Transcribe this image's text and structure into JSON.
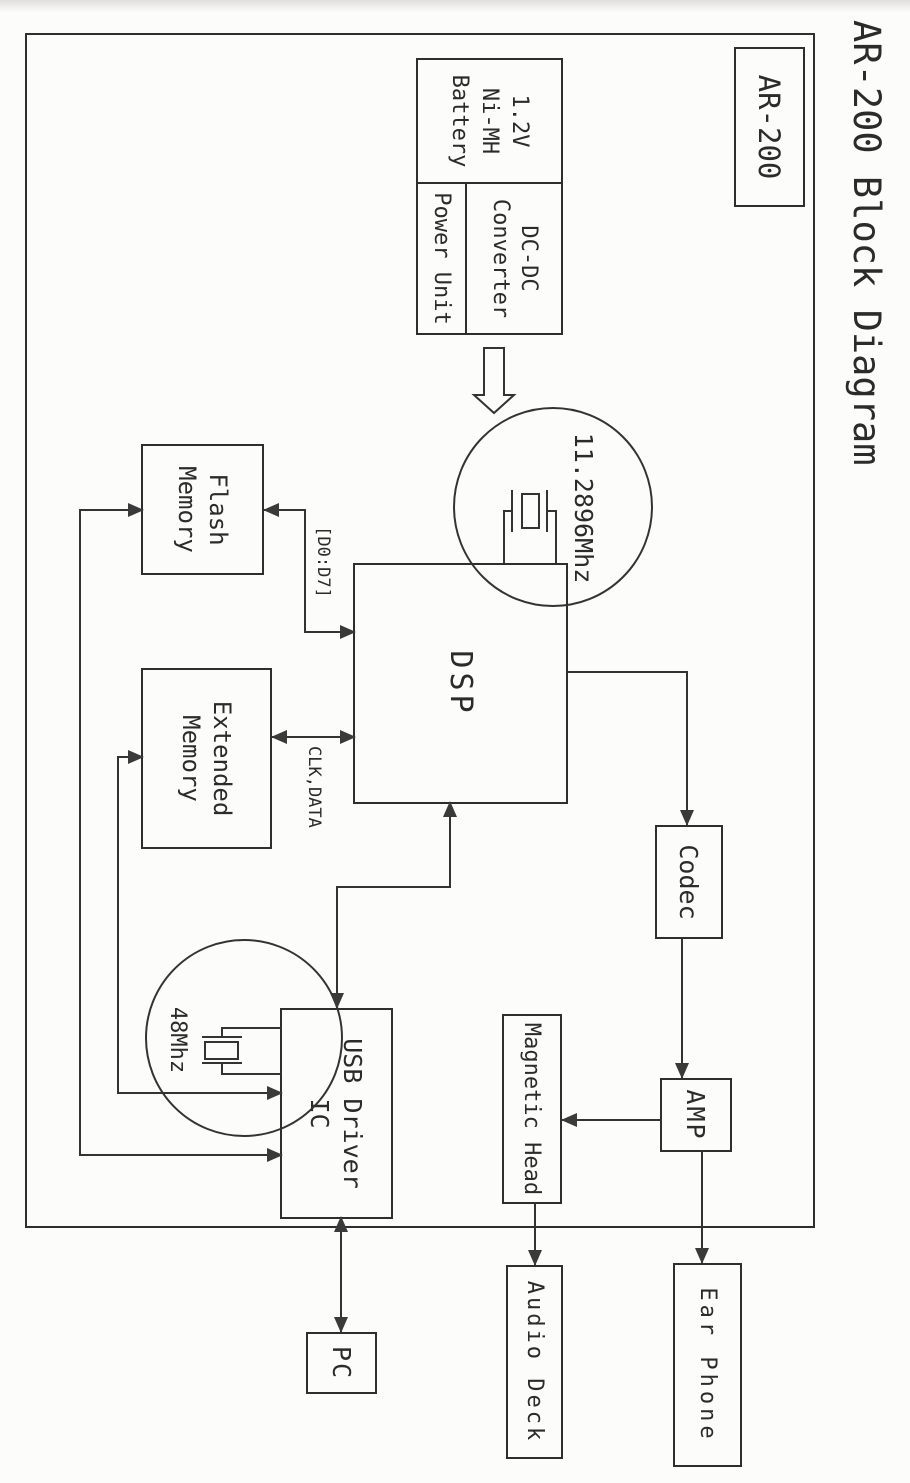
{
  "document": {
    "title": "AR-200 Block Diagram",
    "model_badge": "AR-200"
  },
  "blocks": {
    "battery": "1.2V\nNi-MH\nBattery",
    "dcdc_converter": "DC-DC\nConverter",
    "power_unit": "Power Unit",
    "dsp": "DSP",
    "flash_memory": "Flash\nMemory",
    "extended_memory": "Extended\nMemory",
    "codec": "Codec",
    "amp": "AMP",
    "magnetic_head": "Magnetic Head",
    "audio_deck": "Audio Deck",
    "ear_phone": "Ear Phone",
    "usb_driver_ic": "USB Driver\nIC",
    "pc": "PC"
  },
  "annotations": {
    "main_crystal_freq": "11.2896Mhz",
    "usb_crystal_freq": "48Mhz",
    "data_bus_label": "[D0:D7]",
    "clk_data_label": "CLK,DATA"
  },
  "colors": {
    "ink": "#2b2b2b",
    "paper": "#fcfcfb",
    "arrow_fill": "#3a3a3a"
  }
}
